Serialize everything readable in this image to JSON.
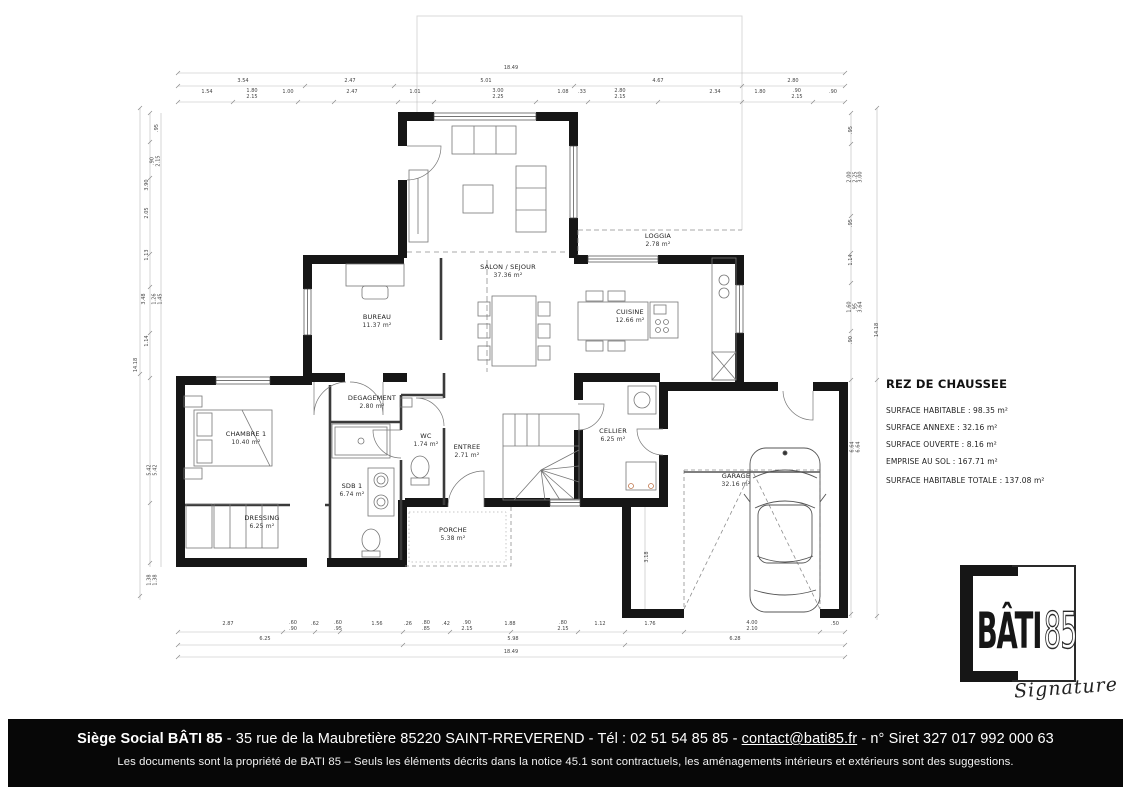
{
  "summary": {
    "title": "REZ DE CHAUSSEE",
    "lines": [
      "SURFACE HABITABLE : 98.35 m²",
      "SURFACE ANNEXE : 32.16 m²",
      "SURFACE OUVERTE : 8.16 m²",
      "EMPRISE AU SOL : 167.71 m²"
    ],
    "total": "SURFACE HABITABLE TOTALE : 137.08 m²"
  },
  "rooms": [
    {
      "name": "SALON / SEJOUR",
      "area": "37.36 m²"
    },
    {
      "name": "CUISINE",
      "area": "12.66 m²"
    },
    {
      "name": "BUREAU",
      "area": "11.37 m²"
    },
    {
      "name": "LOGGIA",
      "area": "2.78 m²"
    },
    {
      "name": "DEGAGEMENT",
      "area": "2.80 m²"
    },
    {
      "name": "CHAMBRE 1",
      "area": "10.40 m²"
    },
    {
      "name": "DRESSING",
      "area": "6.25 m²"
    },
    {
      "name": "SDB 1",
      "area": "6.74 m²"
    },
    {
      "name": "WC",
      "area": "1.74 m²"
    },
    {
      "name": "ENTREE",
      "area": "2.71 m²"
    },
    {
      "name": "CELLIER",
      "area": "6.25 m²"
    },
    {
      "name": "PORCHE",
      "area": "5.38 m²"
    },
    {
      "name": "GARAGE",
      "area": "32.16 m²"
    }
  ],
  "dims": {
    "top_total": "18.49",
    "top_row2": [
      "3.54",
      "2.47",
      "5.01",
      "4.67",
      "2.80"
    ],
    "top_row3": [
      "1.54",
      "1.80",
      "2.15",
      "1.00",
      "2.47",
      "1.01",
      "3.00",
      "2.25",
      "1.08",
      ".33",
      "2.80",
      "2.15",
      "2.34",
      "1.80",
      ".90",
      "2.15",
      ".90"
    ],
    "bottom_row1": [
      "2.87",
      ".60",
      ".90",
      ".62",
      ".60",
      ".95",
      "1.56",
      ".26",
      ".80",
      ".85",
      ".42",
      ".90",
      "2.15",
      "1.88",
      ".80",
      "2.15",
      "1.12",
      "1.76",
      "4.00",
      "2.10",
      ".50"
    ],
    "bottom_row2": [
      "6.25",
      "5.98",
      "6.28"
    ],
    "bottom_total": "18.49",
    "left": [
      ".95",
      ".90",
      "2.15",
      "3.90",
      "2.05",
      "1.13",
      "3.48",
      "1.26",
      "1.45",
      "1.14",
      "5.42",
      "5.42",
      "1.38",
      "1.38"
    ],
    "left_total": "14.18",
    "right": [
      ".95",
      "2.00",
      "2.25",
      "3.00",
      ".95",
      "1.14",
      "1.60",
      ".95",
      "3.64",
      ".90",
      "6.64",
      "6.64"
    ],
    "right_total": "14.18",
    "garage_side": "3.18"
  },
  "logo": {
    "brand": "BÂTI",
    "number": "85",
    "tagline": "Signature"
  },
  "footer": {
    "company": "Siège Social BÂTI 85",
    "sep": " - ",
    "address": "35 rue de la Maubretière 85220 SAINT-RREVEREND",
    "phone": "Tél : 02 51 54 85 85",
    "email": "contact@bati85.fr",
    "siret": "n° Siret 327 017 992 000 63",
    "notice": "Les documents sont la propriété de BATI 85 – Seuls les éléments décrits dans la notice 45.1 sont contractuels, les aménagements intérieurs et extérieurs sont des suggestions."
  }
}
